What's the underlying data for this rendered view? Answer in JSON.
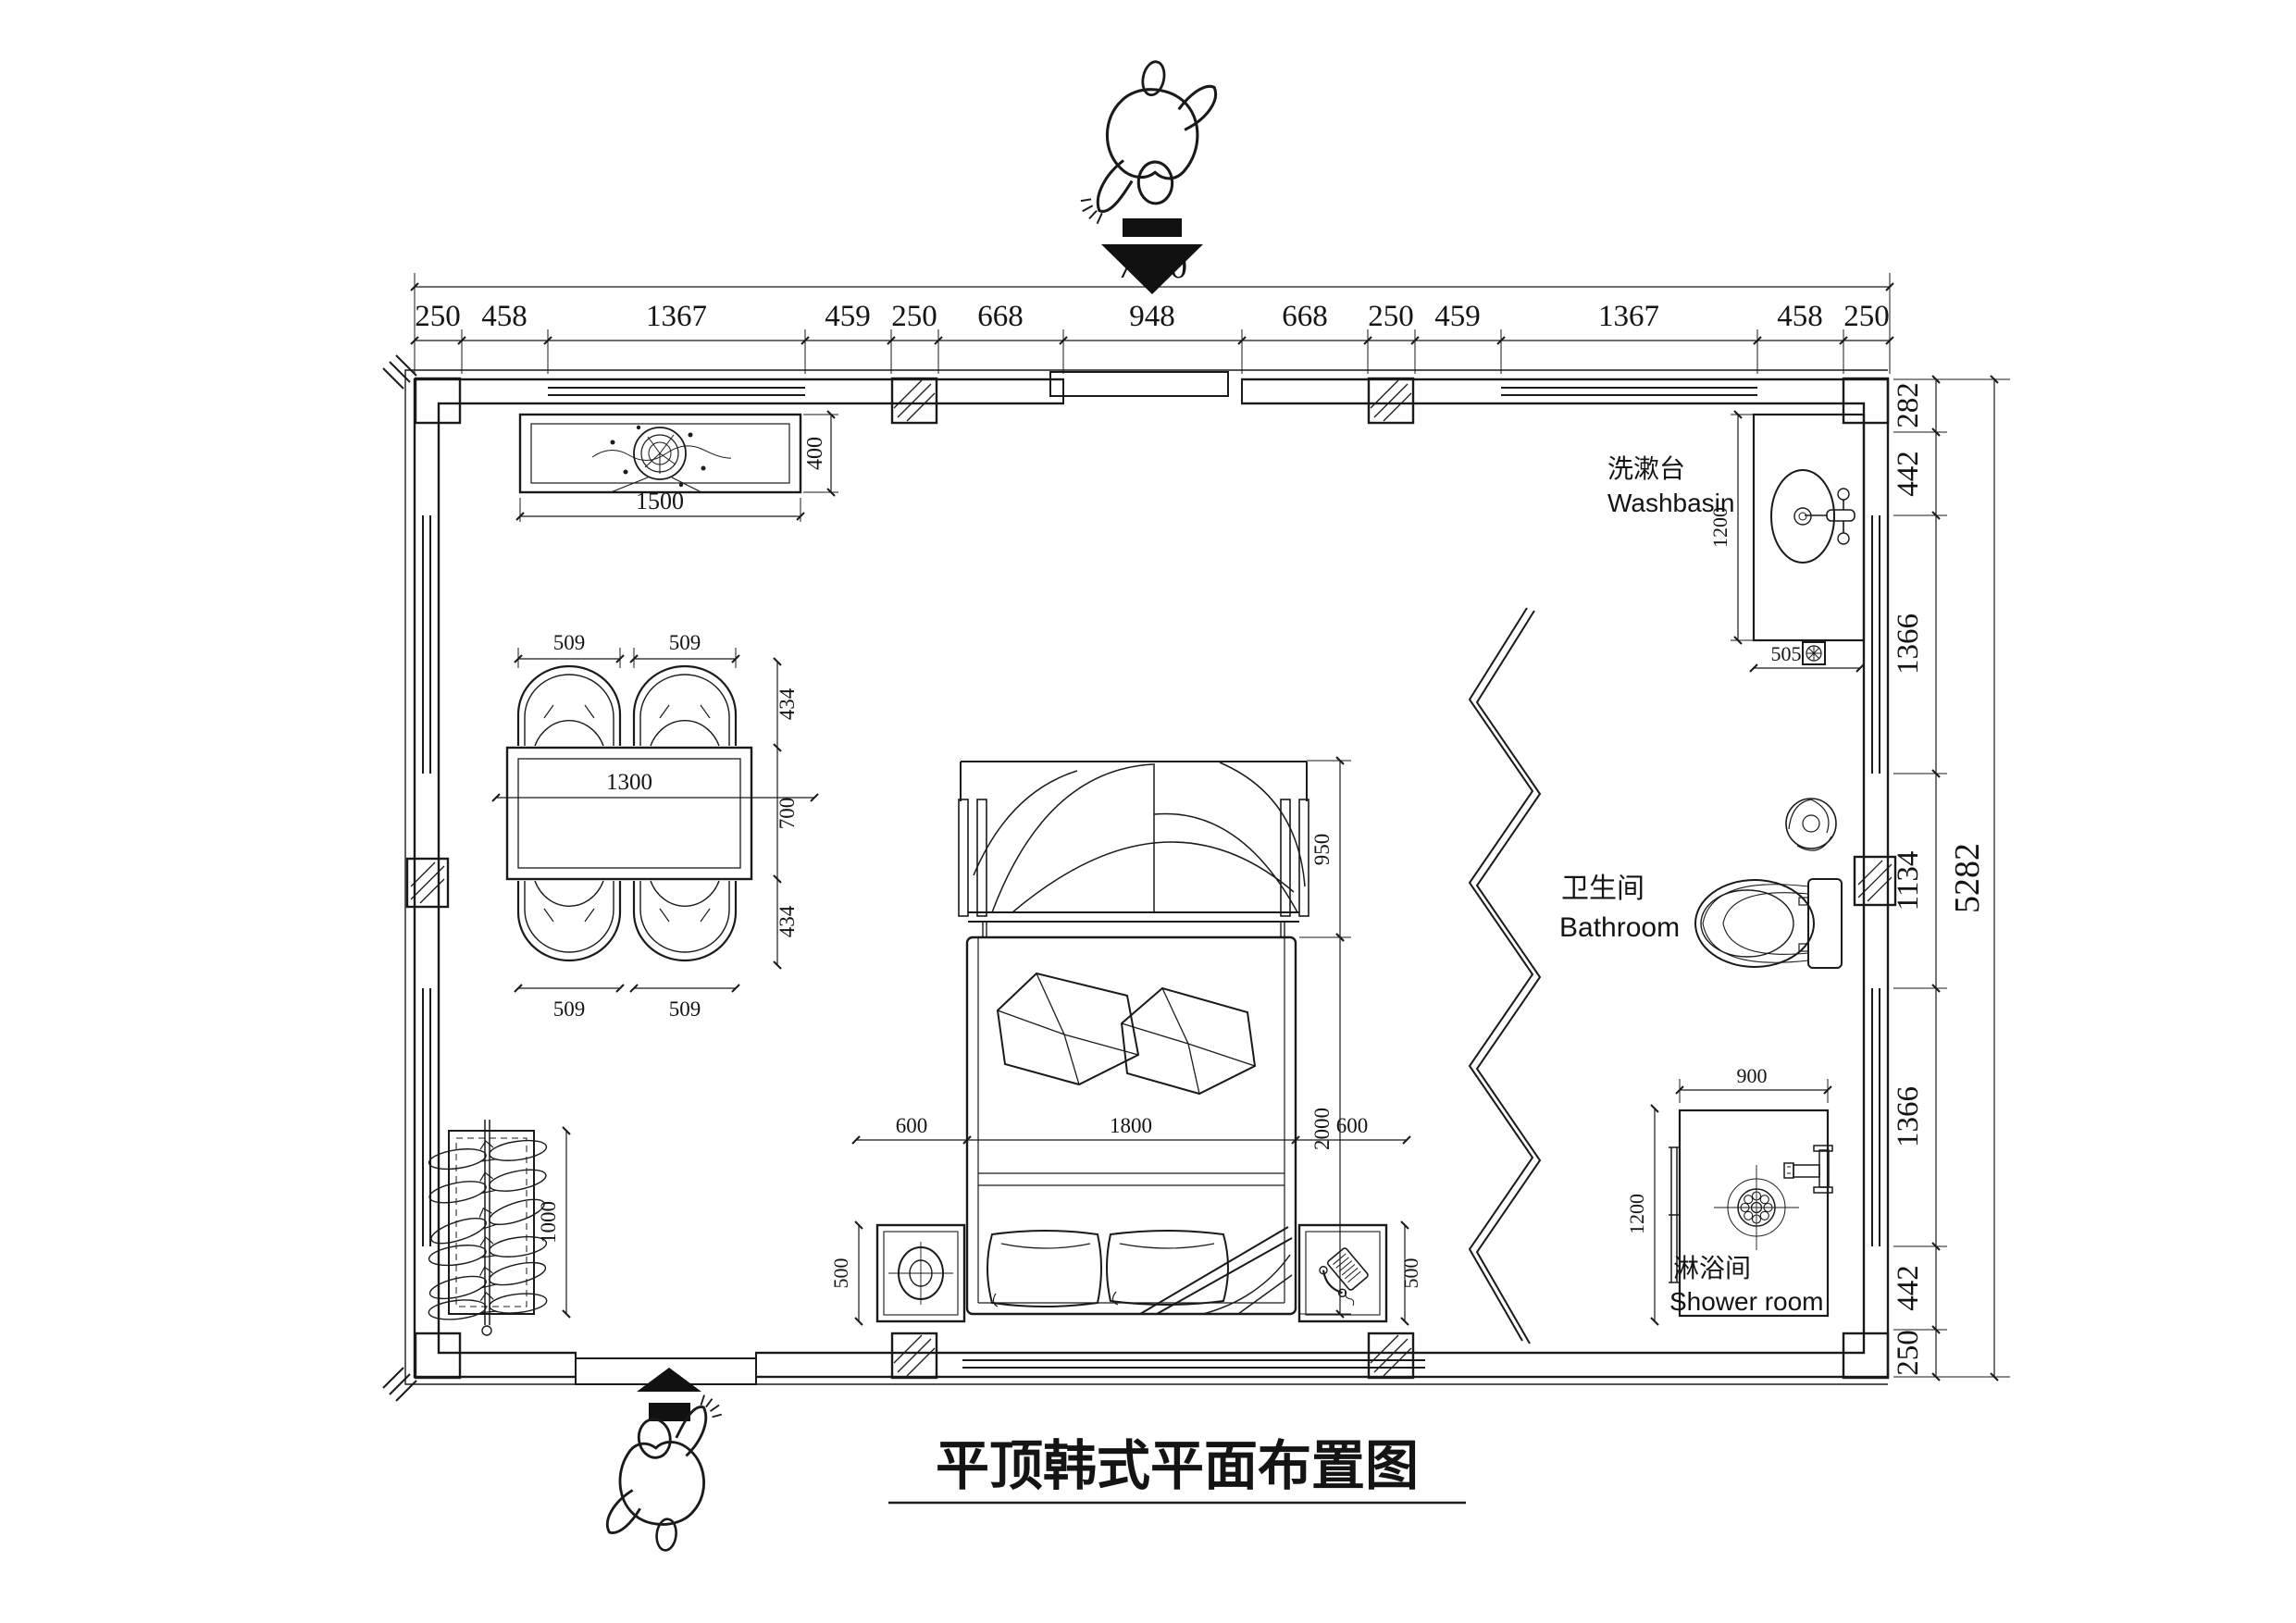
{
  "drawing": {
    "title": "平顶韩式平面布置图",
    "dims": {
      "top_total": "7850",
      "top": [
        "250",
        "458",
        "1367",
        "459",
        "250",
        "668",
        "948",
        "668",
        "250",
        "459",
        "1367",
        "458",
        "250"
      ],
      "right_total": "5282",
      "right": [
        "282",
        "442",
        "1366",
        "1134",
        "1366",
        "442",
        "250"
      ],
      "counter": {
        "width": "1500",
        "depth": "400"
      },
      "dining": {
        "chairs": [
          "509",
          "509",
          "509",
          "509"
        ],
        "sides": [
          "434",
          "434"
        ],
        "table_width": "1300",
        "table_depth": "700"
      },
      "bed": {
        "canopy": "950",
        "length": "2000",
        "width": "1800",
        "sides": [
          "600",
          "600"
        ],
        "nightstands": [
          "500",
          "500"
        ]
      },
      "wardrobe_length": "1000",
      "washbasin": {
        "counter": "1200",
        "drain": "505"
      },
      "shower": {
        "width": "900",
        "depth": "1200"
      }
    },
    "labels": {
      "washbasin_zh": "洗漱台",
      "washbasin_en": "Washbasin",
      "bathroom_zh": "卫生间",
      "bathroom_en": "Bathroom",
      "shower_zh": "淋浴间",
      "shower_en": "Shower room"
    },
    "colors": {
      "ink": "#1a1a1a",
      "paper": "#ffffff"
    }
  }
}
